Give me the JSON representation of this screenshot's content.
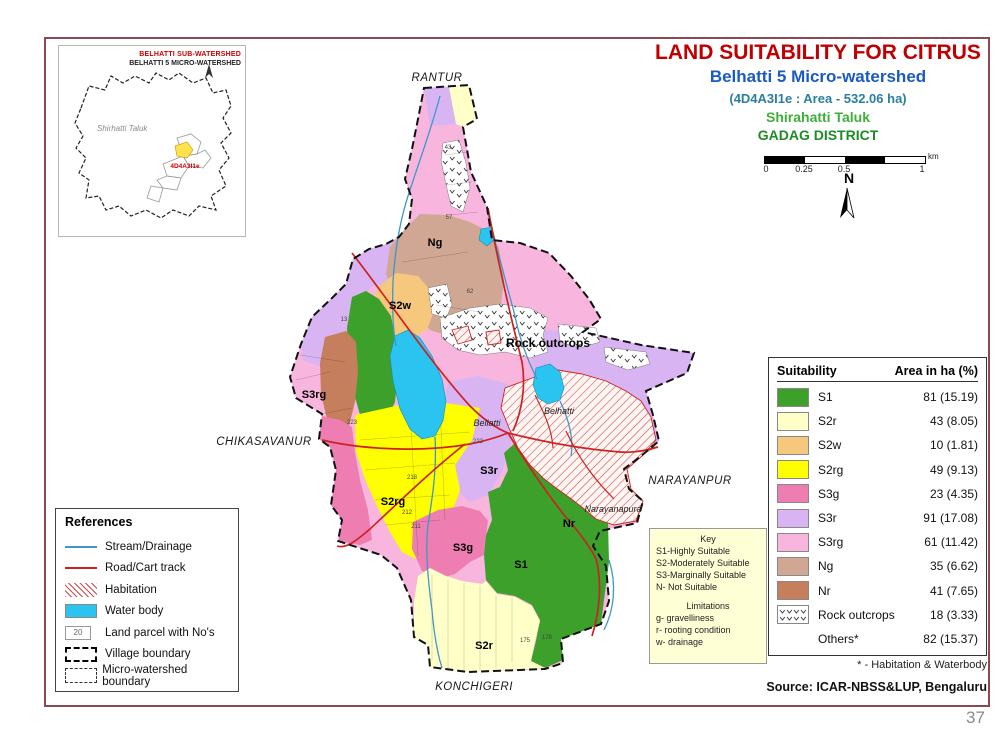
{
  "page": {
    "number": "37"
  },
  "titles": {
    "main": "LAND SUITABILITY FOR CITRUS",
    "sub": "Belhatti 5 Micro-watershed",
    "code": "(4D4A3I1e : Area - 532.06 ha)",
    "taluk": "Shirahatti Taluk",
    "district": "GADAG DISTRICT"
  },
  "inset": {
    "title_red": "BELHATTI SUB-WATERSHED",
    "title_black": "BELHATTI 5 MICRO-WATERSHED",
    "taluk": "Shirhatti Taluk",
    "code": "4D4A3I1e"
  },
  "scale_bar": {
    "ticks": [
      "0",
      "0.25",
      "0.5",
      "1"
    ],
    "unit": "km",
    "north_label": "N"
  },
  "references": {
    "title": "References",
    "items": [
      {
        "label": "Stream/Drainage",
        "symbol": "stream"
      },
      {
        "label": "Road/Cart track",
        "symbol": "road"
      },
      {
        "label": "Habitation",
        "symbol": "habitation"
      },
      {
        "label": "Water body",
        "symbol": "water"
      },
      {
        "label": "Land parcel with No's",
        "symbol": "parcel",
        "box_text": "20"
      },
      {
        "label": "Village boundary",
        "symbol": "village"
      },
      {
        "label": "Micro-watershed boundary",
        "symbol": "watershed"
      }
    ]
  },
  "key_box": {
    "title": "Key",
    "lines": [
      "S1-Highly Suitable",
      "S2-Moderately Suitable",
      "S3-Marginally Suitable",
      "N- Not Suitable"
    ],
    "limitations_title": "Limitations",
    "limitation_lines": [
      "g- gravelliness",
      "r- rooting condition",
      "w- drainage"
    ]
  },
  "suitability_table": {
    "col1": "Suitability",
    "col2": "Area in ha (%)",
    "rows": [
      {
        "label": "S1",
        "value": "81 (15.19)",
        "color_key": "s1"
      },
      {
        "label": "S2r",
        "value": "43 (8.05)",
        "color_key": "s2r"
      },
      {
        "label": "S2w",
        "value": "10 (1.81)",
        "color_key": "s2w"
      },
      {
        "label": "S2rg",
        "value": "49 (9.13)",
        "color_key": "s2rg"
      },
      {
        "label": "S3g",
        "value": "23 (4.35)",
        "color_key": "s3g"
      },
      {
        "label": "S3r",
        "value": "91 (17.08)",
        "color_key": "s3r"
      },
      {
        "label": "S3rg",
        "value": "61 (11.42)",
        "color_key": "s3rg"
      },
      {
        "label": "Ng",
        "value": "35 (6.62)",
        "color_key": "ng"
      },
      {
        "label": "Nr",
        "value": "41 (7.65)",
        "color_key": "nr"
      },
      {
        "label": "Rock outcrops",
        "value": "18 (3.33)",
        "pattern": true
      },
      {
        "label": "Others*",
        "value": "82 (15.37)"
      }
    ],
    "footnote": "* -  Habitation & Waterbody",
    "source": "Source: ICAR-NBSS&LUP, Bengaluru"
  },
  "map": {
    "labels": {
      "ng": {
        "text": "Ng"
      },
      "s2w": {
        "text": "S2w"
      },
      "rock": {
        "text": "Rock outcrops"
      },
      "s3rg": {
        "text": "S3rg"
      },
      "s3r": {
        "text": "S3r"
      },
      "s2rg": {
        "text": "S2rg"
      },
      "s3g": {
        "text": "S3g"
      },
      "s1": {
        "text": "S1"
      },
      "nr": {
        "text": "Nr"
      },
      "s2r": {
        "text": "S2r"
      }
    },
    "places": {
      "rantur": {
        "text": "RANTUR"
      },
      "chikasavanur": {
        "text": "CHIKASAVANUR"
      },
      "narayanpur": {
        "text": "NARAYANPUR"
      },
      "konchigeri": {
        "text": "KONCHIGERI"
      }
    },
    "villages": {
      "bellatti": {
        "text": "Bellatti"
      },
      "belhatti": {
        "text": "Belhatti"
      },
      "narayanapura": {
        "text": "Narayanapura"
      }
    },
    "parcel_numbers": [
      {
        "n": "43",
        "x": 448,
        "y": 149
      },
      {
        "n": "57",
        "x": 449,
        "y": 219
      },
      {
        "n": "62",
        "x": 470,
        "y": 293
      },
      {
        "n": "13",
        "x": 344,
        "y": 321
      },
      {
        "n": "223",
        "x": 352,
        "y": 424
      },
      {
        "n": "222",
        "x": 478,
        "y": 443
      },
      {
        "n": "218",
        "x": 412,
        "y": 479
      },
      {
        "n": "212",
        "x": 407,
        "y": 514
      },
      {
        "n": "211",
        "x": 416,
        "y": 528
      },
      {
        "n": "175",
        "x": 525,
        "y": 642
      },
      {
        "n": "178",
        "x": 547,
        "y": 639
      }
    ]
  },
  "colors": {
    "s1": "#3ca02a",
    "s2r": "#ffffc8",
    "s2w": "#f6c87e",
    "s2rg": "#ffff00",
    "s3g": "#ee7eb2",
    "s3r": "#d9b4f2",
    "s3rg": "#f8b6de",
    "ng": "#cfa793",
    "nr": "#c57f5c",
    "water": "#2bc4f0",
    "stream": "#3f97c9",
    "road": "#cc2222",
    "habitation_hatch": "#cc4a4a",
    "boundary": "#111111",
    "slide_border": "#8a4952",
    "title_red": "#c00000",
    "subtitle_blue": "#1b5ac2",
    "code_teal": "#2a7f9e",
    "taluk_green": "#3fae3a",
    "district_green": "#1e8c25",
    "inset_red": "#cc0000"
  }
}
